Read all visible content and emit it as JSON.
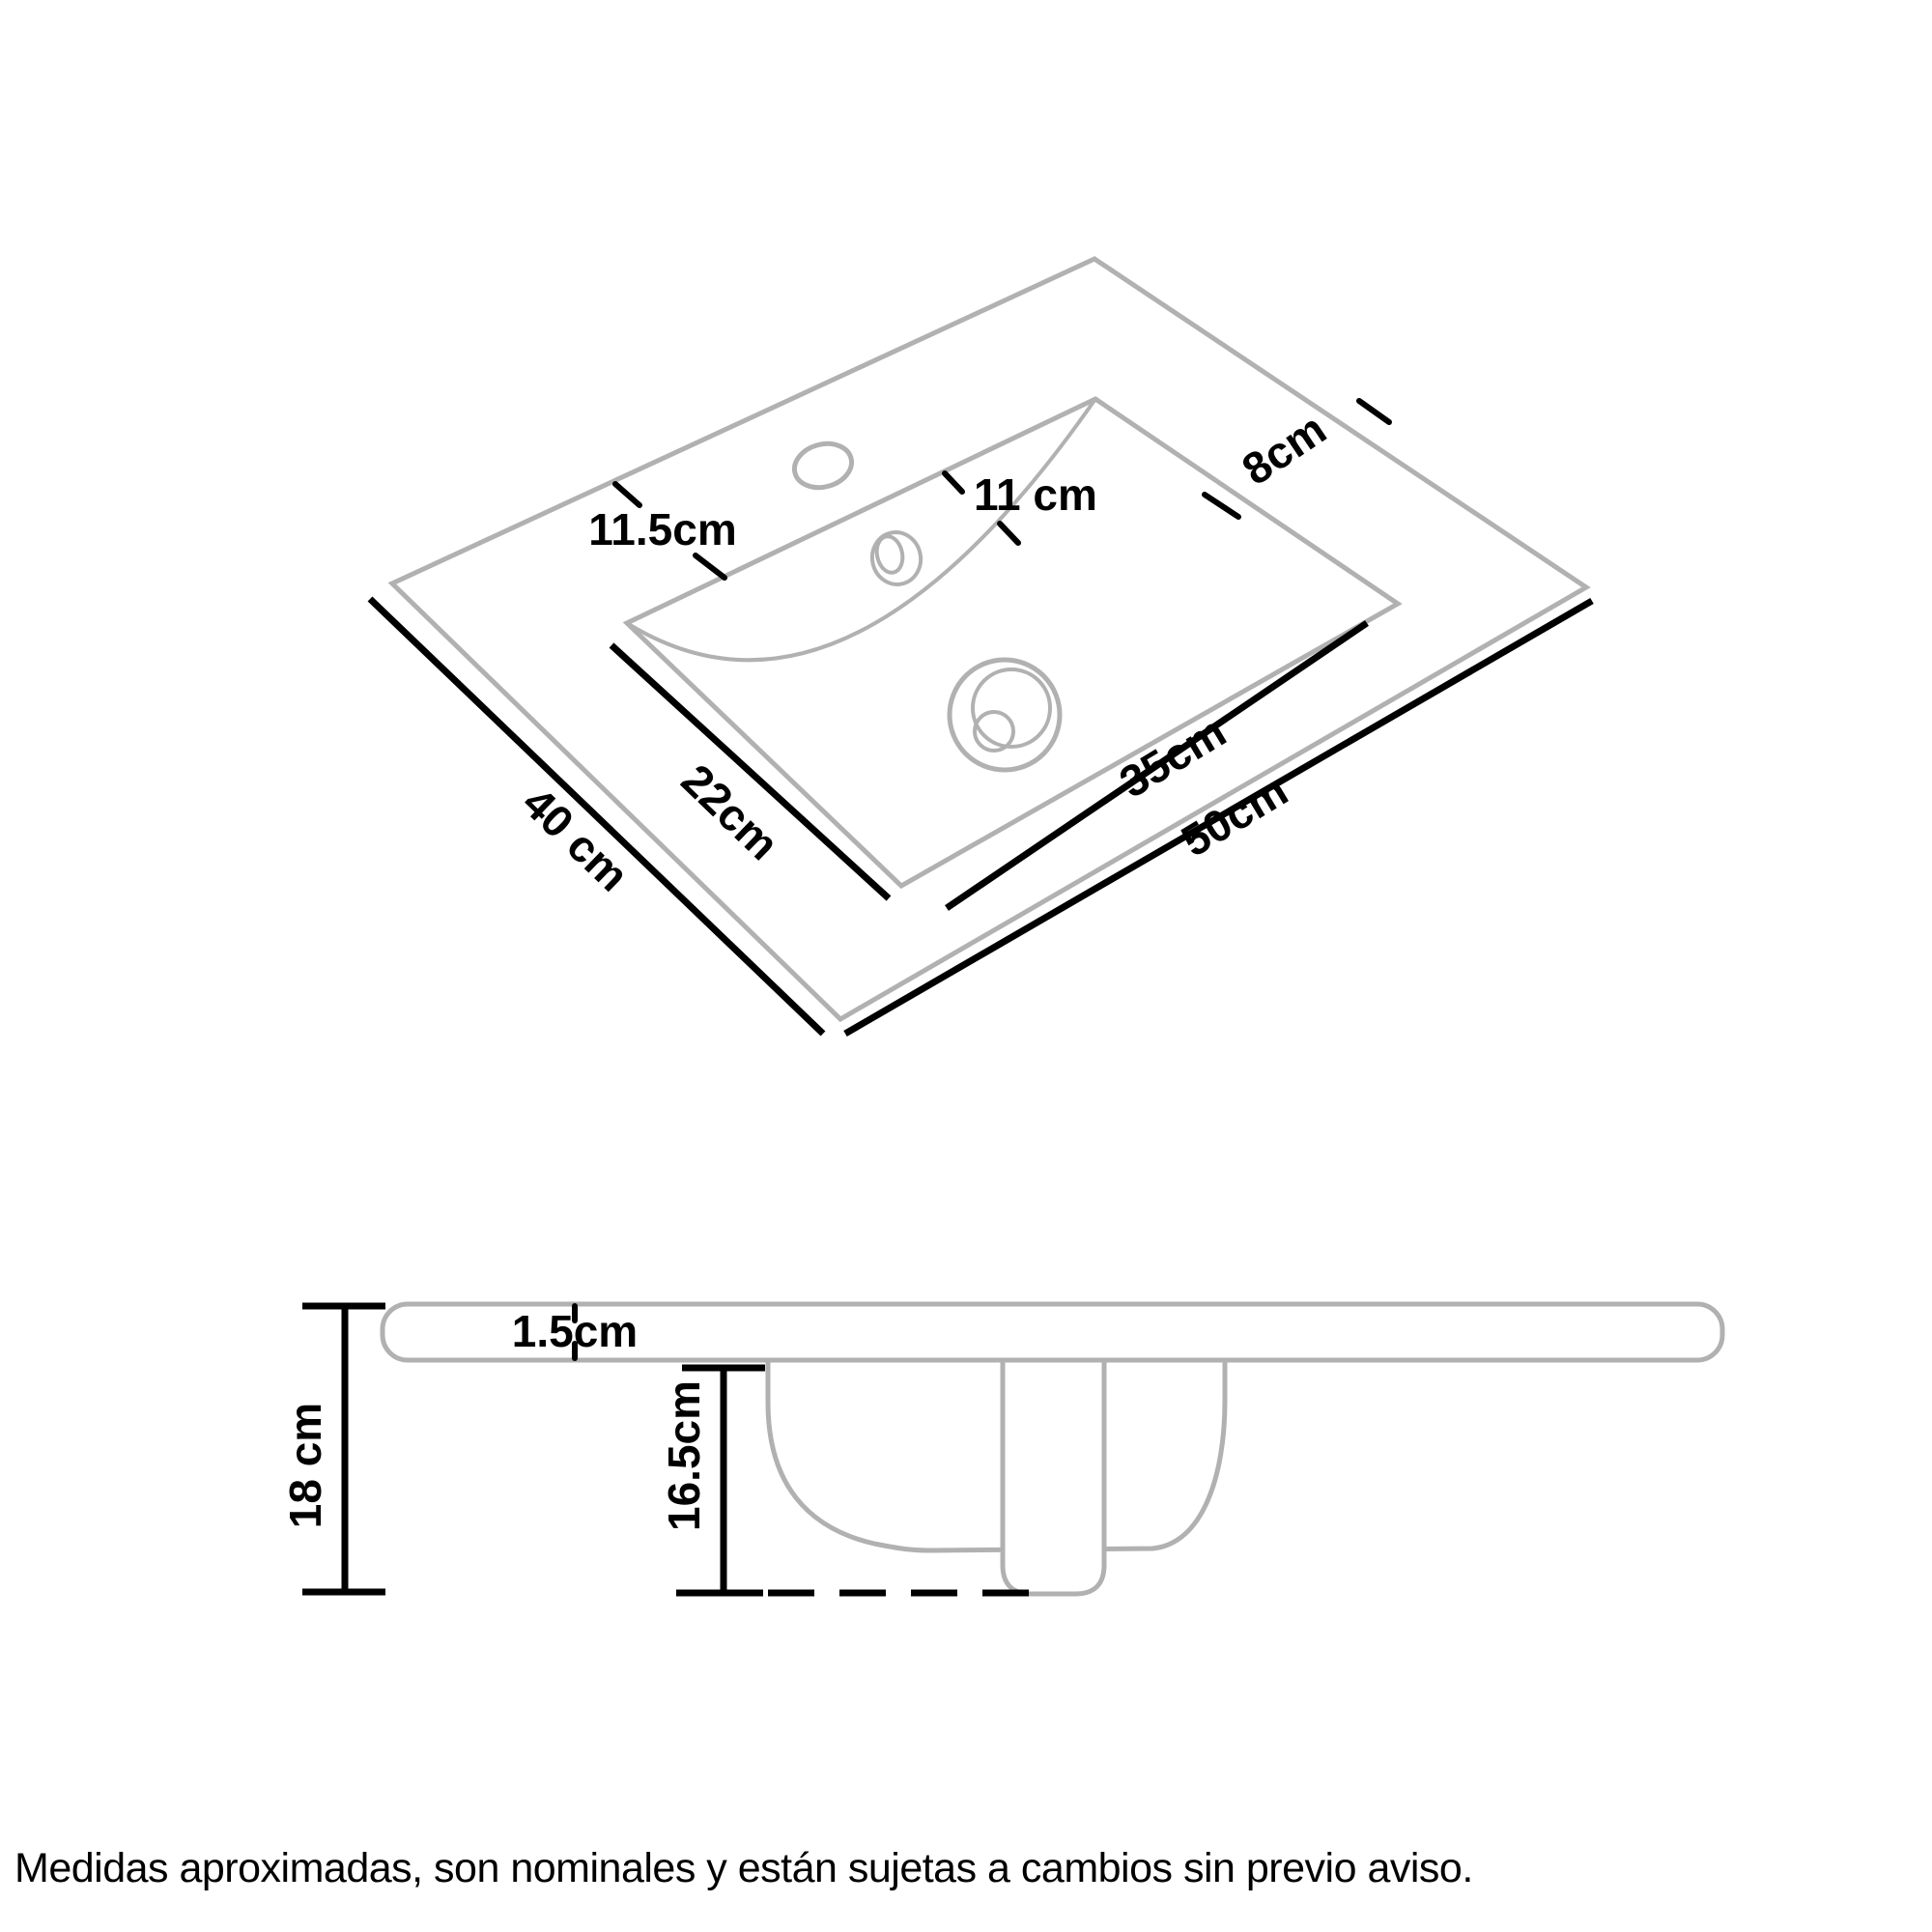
{
  "colors": {
    "outline_gray": "#b1b1b1",
    "dimension_black": "#000000",
    "background": "#ffffff"
  },
  "top_view": {
    "dimensions": {
      "total_width": "50cm",
      "total_depth": "40 cm",
      "basin_width": "35cm",
      "basin_depth": "22cm",
      "left_deck": "11.5cm",
      "faucet_offset": "11 cm",
      "right_deck": "8cm"
    }
  },
  "side_view": {
    "dimensions": {
      "total_height": "18 cm",
      "countertop_thickness": "1.5cm",
      "basin_depth": "16.5cm"
    }
  },
  "footer": {
    "disclaimer": "Medidas aproximadas, son nominales y están sujetas a cambios sin previo aviso."
  }
}
